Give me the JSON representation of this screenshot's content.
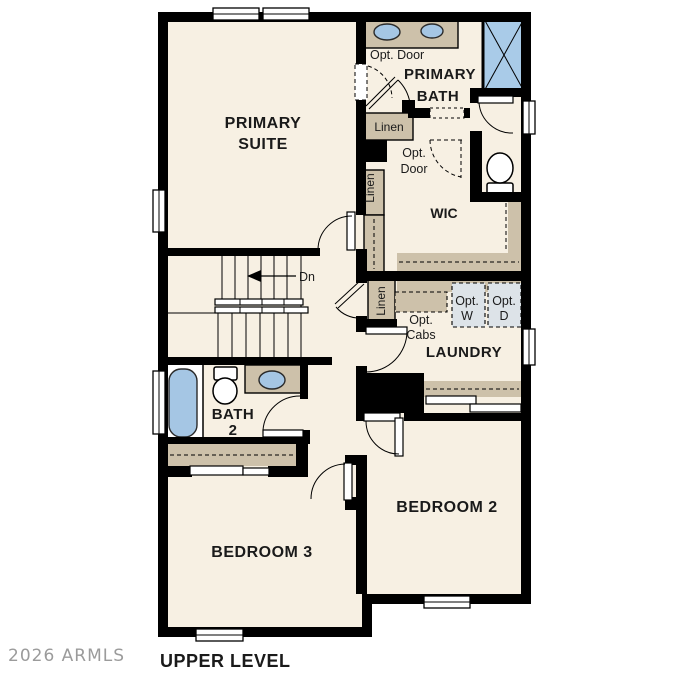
{
  "watermark": "2026 ARMLS",
  "title": "UPPER LEVEL",
  "rooms": {
    "primary_suite": [
      "PRIMARY",
      "SUITE"
    ],
    "primary_bath": [
      "PRIMARY",
      "BATH"
    ],
    "wic": "WIC",
    "laundry": "LAUNDRY",
    "bath2": [
      "BATH",
      "2"
    ],
    "bedroom2": "BEDROOM 2",
    "bedroom3": "BEDROOM 3"
  },
  "labels": {
    "opt_door_bath": "Opt. Door",
    "opt_door_wic": [
      "Opt.",
      "Door"
    ],
    "linen_bath": "Linen",
    "linen_hall": "Linen",
    "linen_laundry": "Linen",
    "opt_cabs": [
      "Opt.",
      "Cabs"
    ],
    "opt_washer": [
      "Opt.",
      "W"
    ],
    "opt_dryer": [
      "Opt.",
      "D"
    ],
    "stairs_down": "Dn"
  },
  "colors": {
    "floor": "#f7f0e3",
    "cabinet_tan": "#cdc1aa",
    "fixture_blue": "#a5c6e4",
    "appliance_gray": "#dde3e8",
    "wall_black": "#000000",
    "watermark_gray": "#9b9b9b"
  }
}
